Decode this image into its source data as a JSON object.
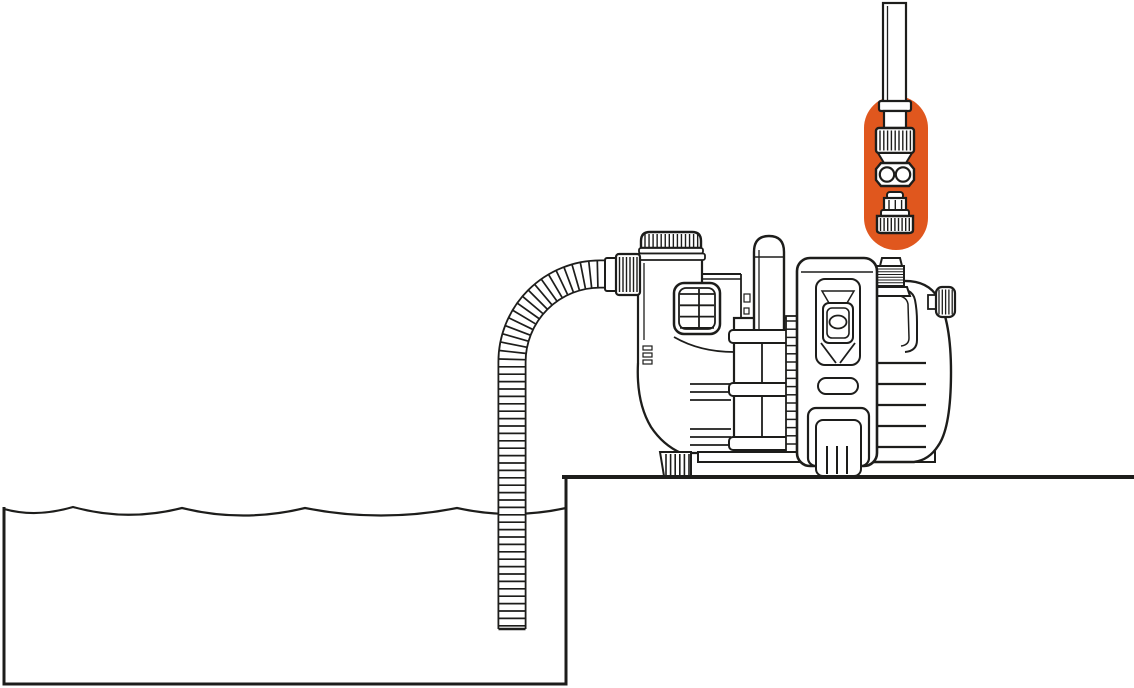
{
  "illustration": {
    "kind": "instruction-line-drawing",
    "subject": "garden pump installed on a ledge drawing water from a reservoir through a corrugated suction hose; hose connector kit highlighted",
    "parts": [
      {
        "id": "connector-kit-highlight",
        "label": "hose connector set (highlighted accessory)"
      },
      {
        "id": "delivery-hose",
        "label": "delivery hose"
      },
      {
        "id": "garden-pump",
        "label": "garden pump"
      },
      {
        "id": "suction-hose",
        "label": "corrugated suction hose"
      },
      {
        "id": "water-reservoir",
        "label": "water reservoir"
      },
      {
        "id": "platform-ledge",
        "label": "platform ledge"
      }
    ]
  },
  "colors": {
    "background": "#ffffff",
    "line": "#1d1d1b",
    "accent_orange": "#e0571e"
  }
}
